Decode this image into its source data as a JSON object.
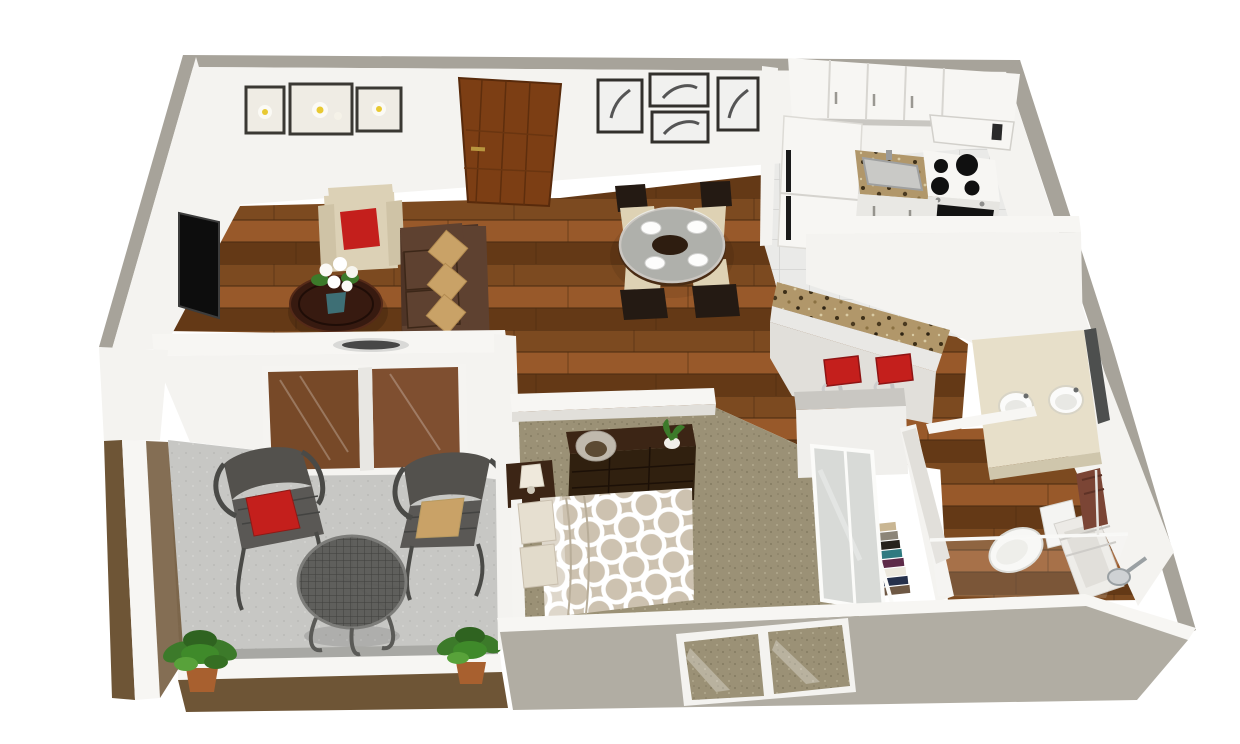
{
  "scene": {
    "type": "3d-floor-plan-render",
    "view": "isometric bird's-eye view of a one-bedroom apartment",
    "background": "#ffffff"
  },
  "colors": {
    "background": "#ffffff",
    "wall_top": "#a7a39a",
    "wall_cap_light": "#f7f6f3",
    "wall_face": "#f4f3f0",
    "wall_face_shade": "#e1dfda",
    "wall_ext": "#b1ada3",
    "patio_wall": "#6e5536",
    "wood_light": "#98592a",
    "wood_mid": "#7c4a20",
    "wood_dark": "#643916",
    "wood_seam": "#4c2b10",
    "tile": "#eaeae8",
    "tile_line": "#d3d3d0",
    "carpet": "#9b9176",
    "carpet_dark": "#837a61",
    "carpet_light": "#b2a98e",
    "concrete": "#c7c7c4",
    "granite_base": "#b1976a",
    "accent_red": "#c41f1c",
    "sofa": "#4e3426",
    "sofa_cushion": "#5e4130",
    "pillow_tan": "#c9a267",
    "chair_wood": "#241a13",
    "seat_cream": "#ded2b4",
    "armchair": "#dcd1b6",
    "coffee_table": "#371a10",
    "glass": "#ccd6d6",
    "duvet": "#cdc2b0",
    "furniture_dark": "#3c2515",
    "door_wood": "#7c3e14",
    "plant_green": "#3c7a2a",
    "iron": "#53514d",
    "steel": "#c6c8c9",
    "towel": "#7b4535",
    "mirror": "#d8dad7"
  },
  "rooms": [
    {
      "id": "living-room",
      "label": "Living Room",
      "floor": "hardwood",
      "items": [
        "wall-mounted flat-screen TV",
        "three framed white-flower prints",
        "cream armchair with red pillow",
        "brown fabric sofa with three tan pillows",
        "round dark-wood coffee table",
        "white lily centerpiece in teal vase"
      ]
    },
    {
      "id": "entry",
      "label": "Entry",
      "items": [
        "wooden front door with brass handle"
      ]
    },
    {
      "id": "dining-area",
      "label": "Dining Area",
      "floor": "hardwood",
      "items": [
        "four black-and-white framed prints",
        "round glass dining table",
        "four place settings with white plates",
        "four espresso chairs with cream seats"
      ]
    },
    {
      "id": "kitchen",
      "label": "Kitchen",
      "floor": "white tile",
      "items": [
        "white upper cabinets",
        "refrigerator",
        "granite counter with inset sink",
        "four-burner range with black oven",
        "microwave"
      ]
    },
    {
      "id": "breakfast-bar",
      "label": "Breakfast Bar",
      "items": [
        "granite bar top on half wall",
        "two red bar stools"
      ]
    },
    {
      "id": "bedroom",
      "label": "Bedroom",
      "floor": "carpet",
      "items": [
        "bed with ring-pattern duvet",
        "two patterned pillows",
        "nightstand with lamp",
        "espresso dresser with hurricane candle and potted plant",
        "exterior window in south wall"
      ]
    },
    {
      "id": "closet",
      "label": "Closet",
      "items": [
        "mirrored sliding doors",
        "clothes rod with hanging clothes"
      ]
    },
    {
      "id": "bathroom",
      "label": "Bathroom",
      "floor": "hardwood",
      "items": [
        "double-sink vanity",
        "toilet",
        "bathtub",
        "shower rod with glass panel",
        "wall-mounted shower head",
        "brown towel"
      ]
    },
    {
      "id": "patio",
      "label": "Patio",
      "floor": "concrete",
      "items": [
        "sliding glass door",
        "wrought-iron chair with red pillow",
        "wrought-iron chair with tan pillow",
        "round mesh patio table",
        "two potted plants"
      ]
    }
  ],
  "counts": {
    "bar_stools": 2,
    "dining_chairs": 4,
    "place_settings": 4,
    "living_art_frames": 3,
    "dining_art_frames": 4,
    "bathroom_sinks": 2,
    "patio_plants": 2,
    "bed_pillows": 2,
    "sofa_pillows": 3,
    "stove_burners": 4
  },
  "closet_clothes_colors": [
    "#c9b693",
    "#8c8578",
    "#27221d",
    "#2f7a80",
    "#5e2b49",
    "#ece8dd",
    "#25304b",
    "#6e5844"
  ]
}
